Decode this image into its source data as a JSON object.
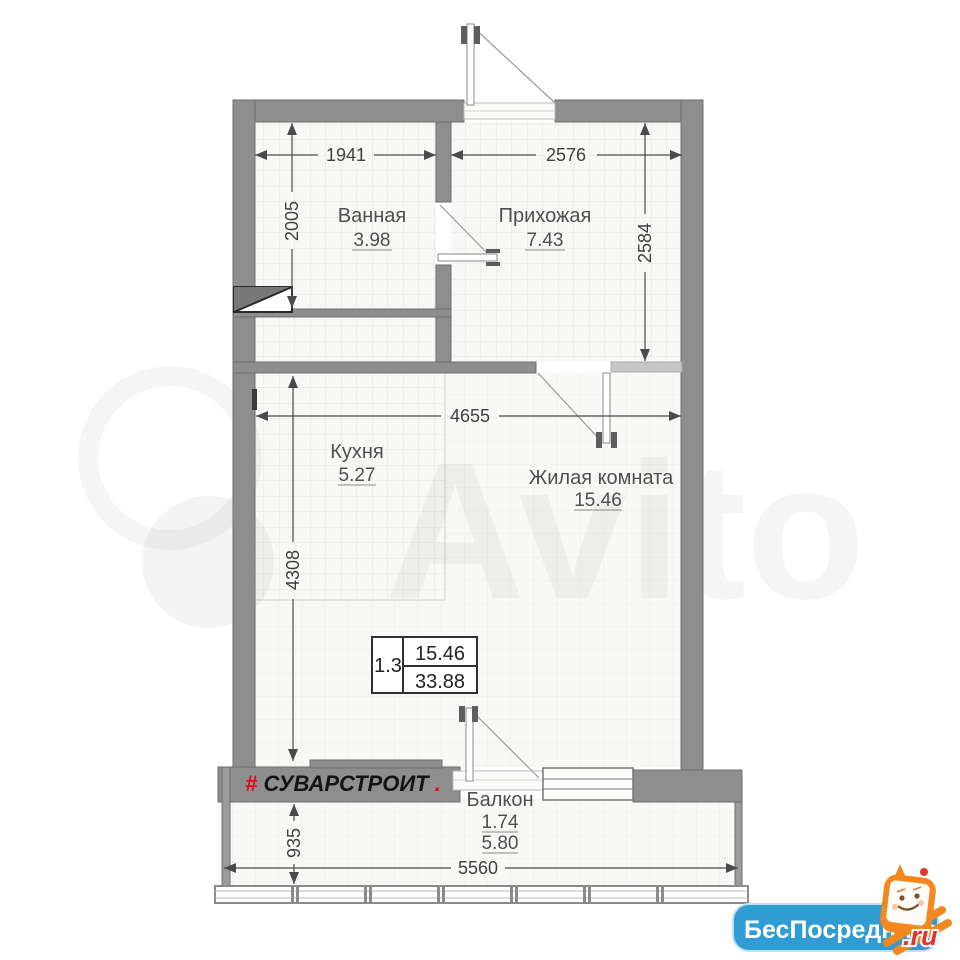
{
  "watermark": {
    "brand": "Avito"
  },
  "rooms": {
    "bathroom": {
      "name": "Ванная",
      "area": "3.98"
    },
    "hallway": {
      "name": "Прихожая",
      "area": "7.43"
    },
    "kitchen": {
      "name": "Кухня",
      "area": "5.27"
    },
    "living": {
      "name": "Жилая комната",
      "area": "15.46"
    },
    "balcony": {
      "name": "Балкон",
      "area_reduced": "1.74",
      "area_full": "5.80"
    }
  },
  "dimensions_mm": {
    "bathroom_width": "1941",
    "bathroom_depth": "2005",
    "hallway_width": "2576",
    "hallway_depth": "2584",
    "living_width": "4655",
    "living_depth": "4308",
    "balcony_depth": "935",
    "balcony_width": "5560"
  },
  "area_table": {
    "plan_type": "1.3",
    "living_area": "15.46",
    "total_area": "33.88"
  },
  "developer_logo": {
    "hash": "#",
    "name": "СУВАРСТРОИТ",
    "dot": "."
  },
  "site_badge": {
    "name": "БесПосредника",
    "tld": ".ru"
  },
  "colors": {
    "wall": "#8e8e8e",
    "wall_light": "#c6c6c6",
    "logo_red": "#e30613",
    "badge_blue": "#2f9cd4",
    "mascot_orange": "#f5871f"
  }
}
